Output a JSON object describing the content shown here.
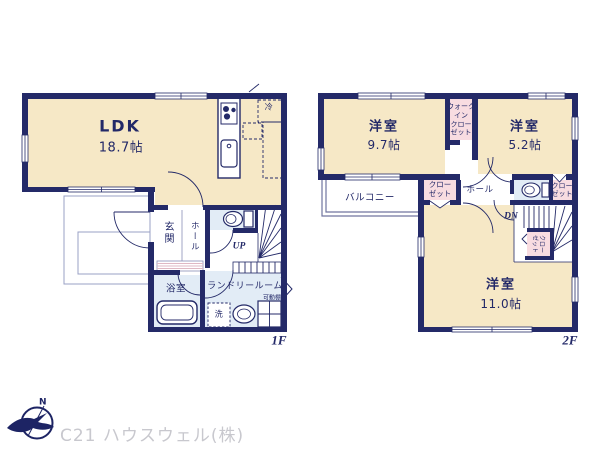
{
  "meta": {
    "kind": "real-estate-floorplan",
    "floors": [
      "1F",
      "2F"
    ]
  },
  "colors": {
    "wall_navy": "#242a68",
    "room_cream": "#f6e8c6",
    "closet_pink": "#f8dce1",
    "wet_area_blue": "#e2ecf6",
    "threshold_pink": "#dfb9c4",
    "thin_line": "#8b90b8",
    "label_navy": "#232968",
    "company_gray": "#c8c8ce"
  },
  "floor1": {
    "label": "1F",
    "ldk": {
      "name": "LDK",
      "size": "18.7帖"
    },
    "genkan": "玄関",
    "hall": "ホール",
    "up": "UP",
    "bath": "浴室",
    "laundry": "ランドリールーム",
    "washer": "洗",
    "shelf": "可動棚",
    "fridge": "冷"
  },
  "floor2": {
    "label": "2F",
    "room_97": {
      "name": "洋室",
      "size": "9.7帖"
    },
    "room_52": {
      "name": "洋室",
      "size": "5.2帖"
    },
    "room_110": {
      "name": "洋室",
      "size": "11.0帖"
    },
    "wic": "ウォーク\nイン\nクロー\nゼット",
    "balcony": "バルコニー",
    "closet_hall": "クロー\nゼット",
    "closet_52": "クロー\nゼット",
    "closet_stairs": "クロー\nゼット",
    "hall": "ホール",
    "down": "DN"
  },
  "footer": {
    "compass_n": "N",
    "company": "C21 ハウスウェル(株)"
  }
}
